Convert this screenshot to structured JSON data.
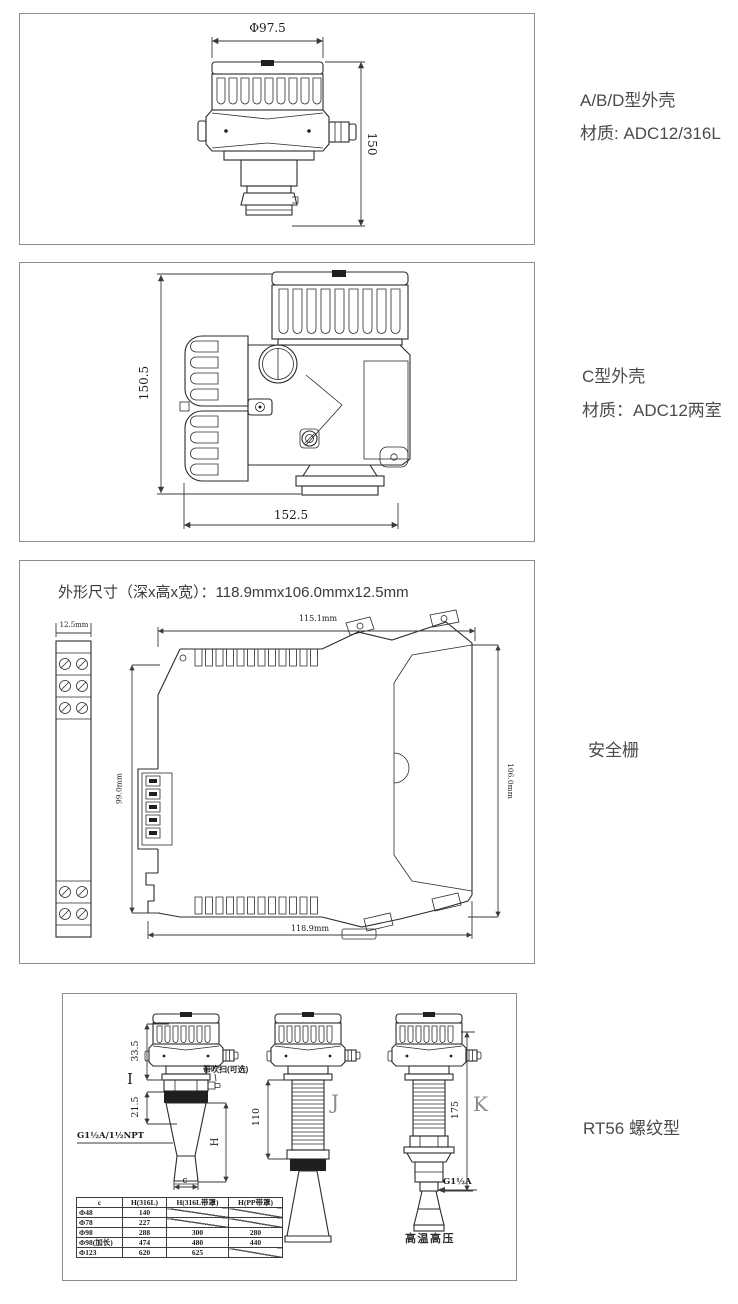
{
  "side_labels": {
    "panel1_line1": "A/B/D型外壳",
    "panel1_line2": "材质: ADC12/316L",
    "panel2_line1": "C型外壳",
    "panel2_line2": "材质：ADC12两室",
    "panel3": "安全栅",
    "panel4": "RT56 螺纹型"
  },
  "panel1": {
    "dim_width": "Φ97.5",
    "dim_height": "150"
  },
  "panel2": {
    "dim_height": "150.5",
    "dim_width": "152.5"
  },
  "panel3": {
    "title": "外形尺寸（深x高x宽）：118.9mmx106.0mmx12.5mm",
    "dim_module_width": "12.5mm",
    "dim_top": "115.1mm",
    "dim_left": "99.0mm",
    "dim_right": "106.0mm",
    "dim_bottom": "118.9mm"
  },
  "panel4": {
    "variant_i": {
      "letter": "I",
      "dim_a": "33.5",
      "dim_b": "21.5",
      "dim_h": "H",
      "dim_c": "c",
      "thread": "G1½A/1½NPT",
      "purge": "带吹扫(可选)"
    },
    "variant_j": {
      "letter": "J",
      "dim": "110"
    },
    "variant_k": {
      "letter": "K",
      "dim": "175",
      "thread": "G1½A",
      "caption": "高温高压"
    },
    "table": {
      "headers": [
        "c",
        "H(316L)",
        "H(316L带罩)",
        "H(PP带罩)"
      ],
      "rows": [
        [
          "Φ48",
          "140",
          "/",
          "/"
        ],
        [
          "Φ78",
          "227",
          "/",
          "/"
        ],
        [
          "Φ98",
          "288",
          "300",
          "280"
        ],
        [
          "Φ98(加长)",
          "474",
          "480",
          "440"
        ],
        [
          "Φ123",
          "620",
          "625",
          "/"
        ]
      ]
    }
  }
}
